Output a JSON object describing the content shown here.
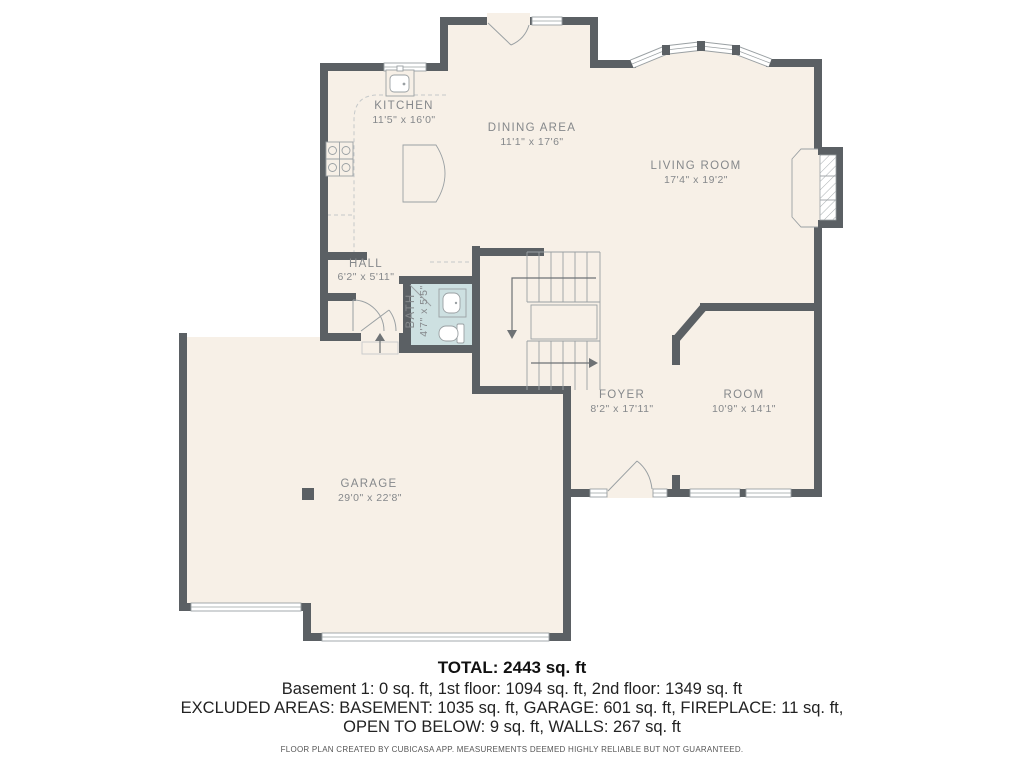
{
  "rooms": [
    {
      "name": "KITCHEN",
      "dims": "11'5\" x 16'0\""
    },
    {
      "name": "DINING AREA",
      "dims": "11'1\" x 17'6\""
    },
    {
      "name": "LIVING ROOM",
      "dims": "17'4\" x 19'2\""
    },
    {
      "name": "HALL",
      "dims": "6'2\" x 5'11\""
    },
    {
      "name": "BATH",
      "dims": "4'7\" x 5'5\""
    },
    {
      "name": "FOYER",
      "dims": "8'2\" x 17'11\""
    },
    {
      "name": "ROOM",
      "dims": "10'9\" x 14'1\""
    },
    {
      "name": "GARAGE",
      "dims": "29'0\" x 22'8\""
    }
  ],
  "summary": {
    "total": "TOTAL: 2443 sq. ft",
    "floors": "Basement 1: 0 sq. ft, 1st floor: 1094 sq. ft, 2nd floor: 1349 sq. ft",
    "excluded_line1": "EXCLUDED AREAS: BASEMENT: 1035 sq. ft, GARAGE: 601 sq. ft, FIREPLACE: 11 sq. ft,",
    "excluded_line2": "OPEN TO BELOW: 9 sq. ft, WALLS: 267 sq. ft",
    "disclaimer": "FLOOR PLAN CREATED BY CUBICASA APP. MEASUREMENTS DEEMED HIGHLY RELIABLE BUT NOT GUARANTEED."
  },
  "colors": {
    "wall": "#5b6064",
    "floor": "#f7f0e7",
    "bath_floor": "#cde0e1",
    "label": "#85888b",
    "fixture": "#9aa0a3"
  }
}
